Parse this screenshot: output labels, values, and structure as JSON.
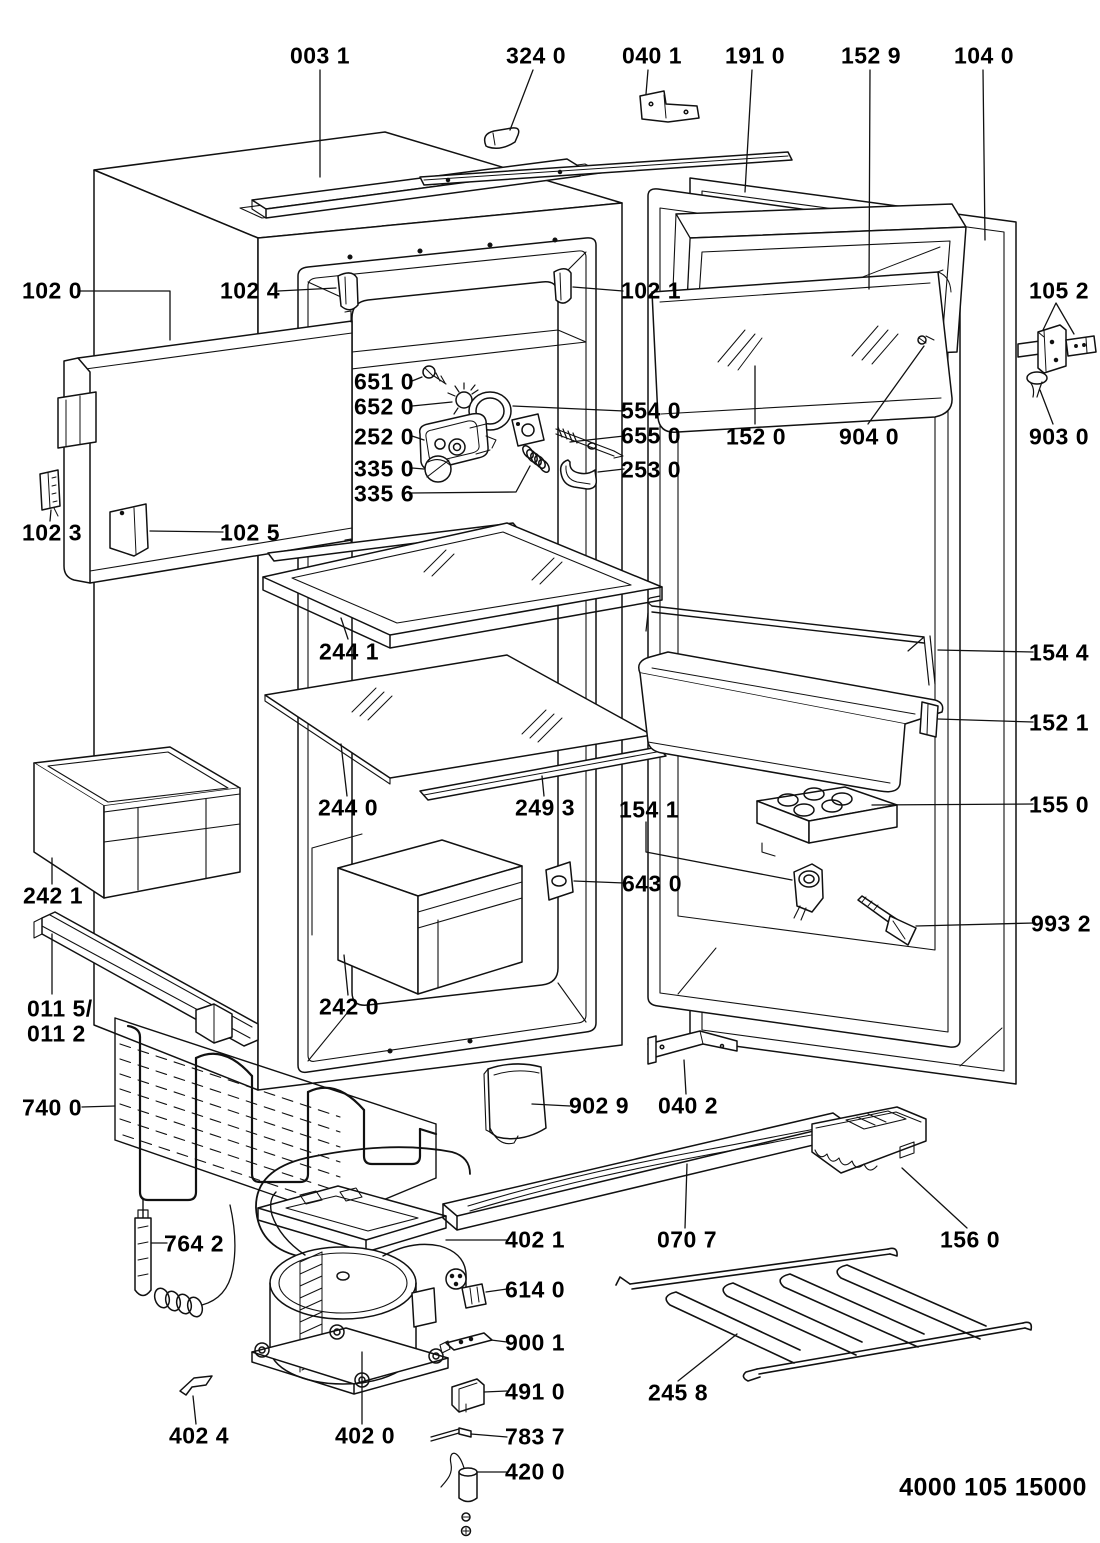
{
  "diagram": {
    "doc_number": "4000 105 15000",
    "background": "#ffffff",
    "line_color": "#111111",
    "callouts": {
      "c003_1": "003 1",
      "c324_0": "324 0",
      "c040_1": "040 1",
      "c191_0": "191 0",
      "c152_9": "152 9",
      "c104_0": "104 0",
      "c102_0": "102 0",
      "c102_4": "102 4",
      "c102_1": "102 1",
      "c105_2": "105 2",
      "c152_0": "152 0",
      "c904_0": "904 0",
      "c903_0": "903 0",
      "c651_0": "651 0",
      "c652_0": "652 0",
      "c252_0": "252 0",
      "c335_0": "335 0",
      "c335_6": "335 6",
      "c554_0": "554 0",
      "c655_0": "655 0",
      "c253_0": "253 0",
      "c102_3": "102 3",
      "c102_5": "102 5",
      "c244_1": "244 1",
      "c154_4": "154 4",
      "c152_1": "152 1",
      "c244_0": "244 0",
      "c249_3": "249 3",
      "c154_1": "154 1",
      "c155_0": "155 0",
      "c242_1": "242 1",
      "c643_0": "643 0",
      "c993_2": "993 2",
      "c011_5": "011 5/",
      "c011_2": "011 2",
      "c242_0": "242 0",
      "c740_0": "740 0",
      "c902_9": "902 9",
      "c040_2": "040 2",
      "c764_2": "764 2",
      "c402_1": "402 1",
      "c070_7": "070 7",
      "c156_0": "156 0",
      "c614_0": "614 0",
      "c900_1": "900 1",
      "c491_0": "491 0",
      "c245_8": "245 8",
      "c783_7": "783 7",
      "c402_4": "402 4",
      "c402_0": "402 0",
      "c420_0": "420 0"
    }
  }
}
